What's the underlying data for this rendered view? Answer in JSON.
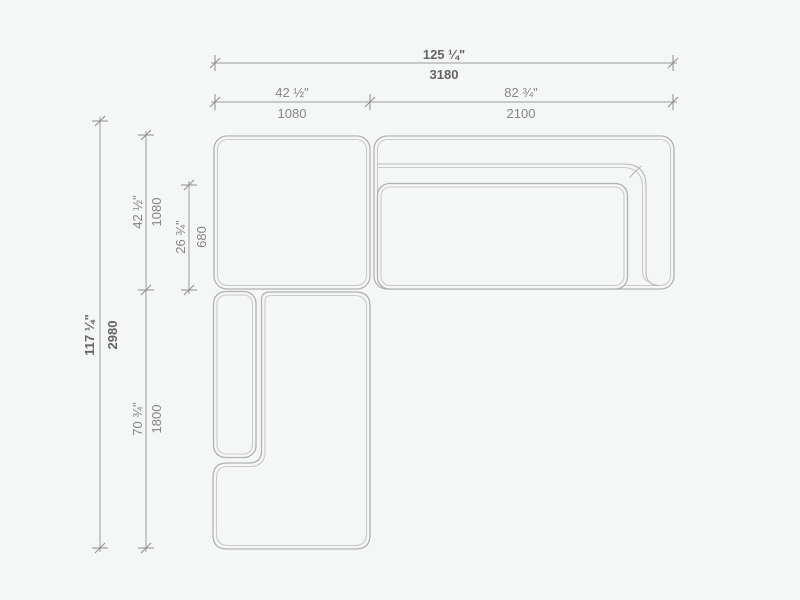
{
  "drawing": {
    "type": "sectional-sofa-plan-dimension-drawing",
    "colors": {
      "background": "#f5f6f6",
      "furniture_outline": "#b2b2b2",
      "furniture_inner_line": "#cacaca",
      "dimension_line": "#9c9c9c",
      "text_regular": "#868686",
      "text_bold": "#646464"
    },
    "dimensions": {
      "overall_width": {
        "imperial": "125 ¼\"",
        "metric": "3180"
      },
      "left_section_width": {
        "imperial": "42 ½\"",
        "metric": "1080"
      },
      "right_section_width": {
        "imperial": "82 ¾\"",
        "metric": "2100"
      },
      "overall_depth": {
        "imperial": "117 ¼\"",
        "metric": "2980"
      },
      "top_section_depth": {
        "imperial": "42 ½\"",
        "metric": "1080"
      },
      "seat_depth": {
        "imperial": "26 ¾\"",
        "metric": "680"
      },
      "chaise_length": {
        "imperial": "70 ¾\"",
        "metric": "1800"
      }
    }
  }
}
